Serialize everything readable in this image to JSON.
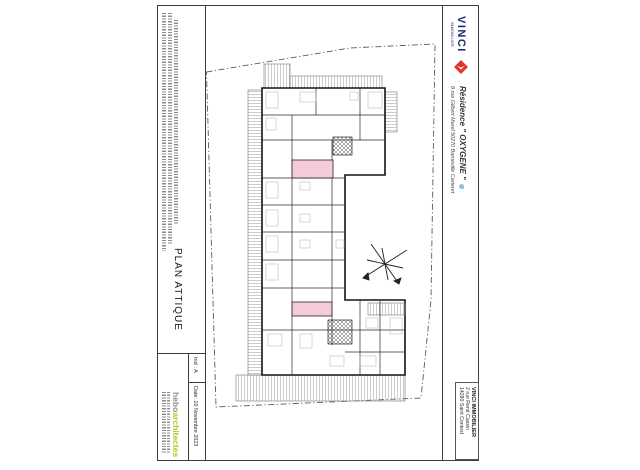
{
  "title_block": {
    "plan_label": "PLAN ATTIQUE",
    "index_label": "Ind : A",
    "date_label": "Date: 10 Novembre 2023",
    "architect": {
      "name": "hebo",
      "suffix": "architectes"
    }
  },
  "project": {
    "residence_line": "Résidence \" OXYGENE \"",
    "address_line": "8 rue Gilbert Marel 50270 Barneville Carteret"
  },
  "developer": {
    "brand": "VINCI",
    "brand_sub": "IMMOBILIER",
    "address_line1": "VINCI IMMOBILIER",
    "address_line2": "2 rue René Cassin",
    "address_line3": "14280 Saint Contest"
  },
  "colors": {
    "vinci_navy": "#1b2a67",
    "vinci_red": "#e0352c",
    "hebo_gray": "#8f8f8b",
    "hebo_green": "#b9c41e",
    "highlight_pink": "#f5cbdb"
  }
}
